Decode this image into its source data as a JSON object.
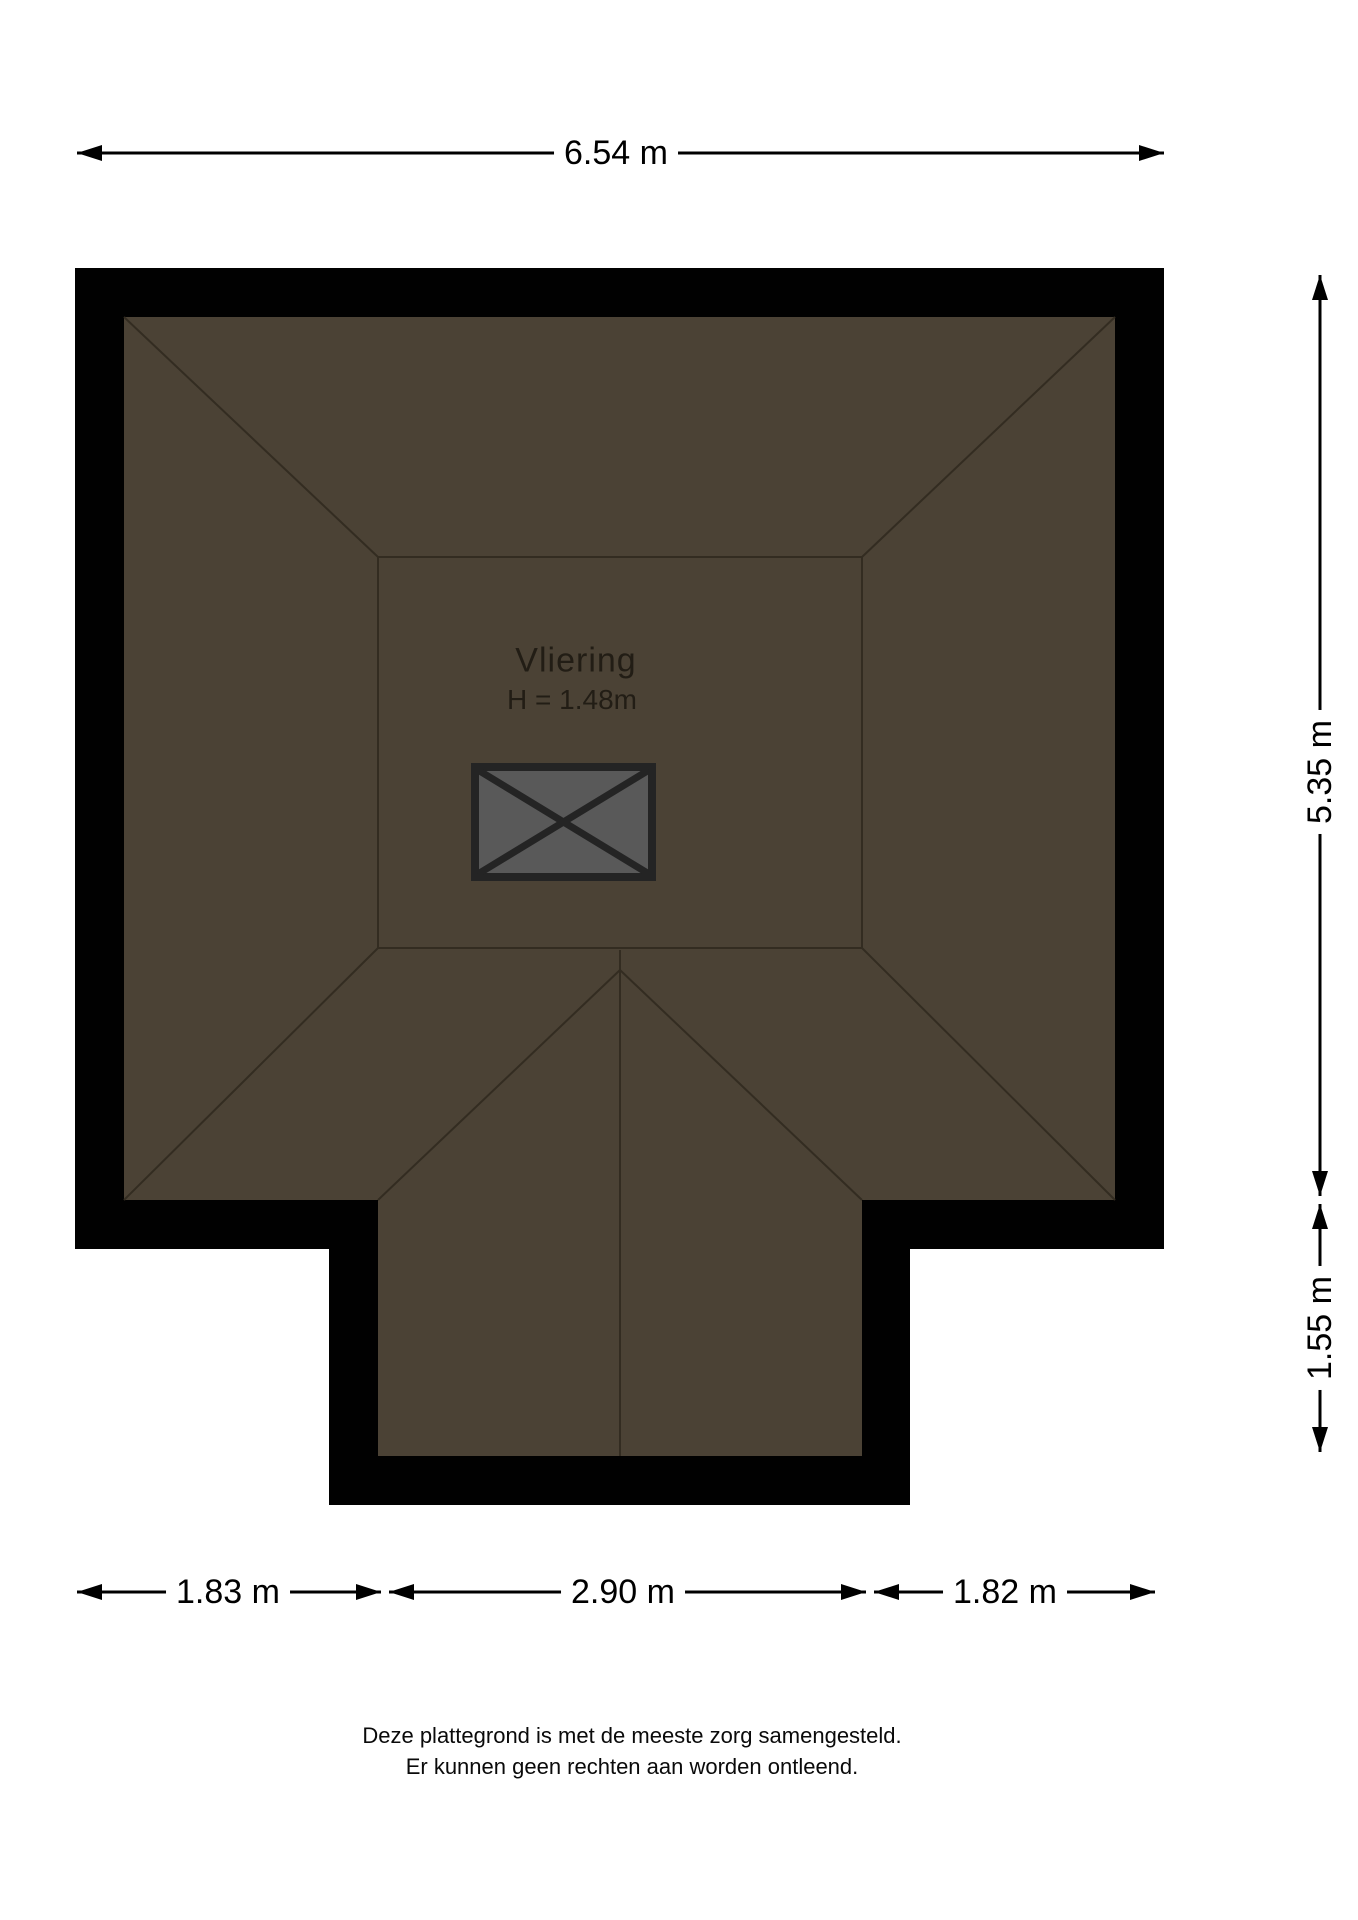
{
  "page": {
    "background_color": "#ffffff"
  },
  "plan": {
    "room_label": "Vliering",
    "room_height_label": "H = 1.48m",
    "colors": {
      "wall": "#010101",
      "floor": "#4b4235",
      "roof_line": "#332c21",
      "hatch_fill": "#595959",
      "hatch_outline": "#242424",
      "dimension_line": "#000000",
      "room_text": "#221d15"
    }
  },
  "dimensions": {
    "top_width": "6.54 m",
    "right_upper_height": "5.35 m",
    "right_lower_height": "1.55 m",
    "bottom_left_width": "1.83 m",
    "bottom_middle_width": "2.90 m",
    "bottom_right_width": "1.82 m"
  },
  "footer": {
    "line1": "Deze plattegrond is met de meeste zorg samengesteld.",
    "line2": "Er kunnen geen rechten aan worden ontleend."
  }
}
